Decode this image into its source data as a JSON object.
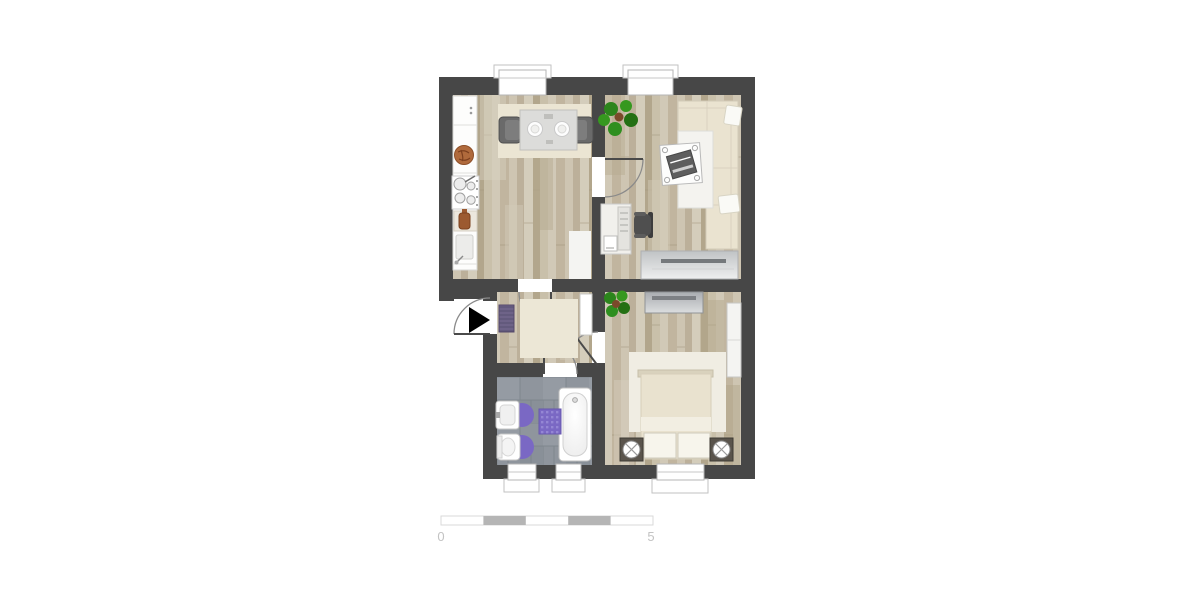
{
  "image": {
    "width": 1200,
    "height": 600,
    "background": "#ffffff"
  },
  "scale_bar": {
    "start_label": "0",
    "end_label": "5",
    "segments": 5,
    "segment_fill": "#b5b5b5",
    "outline": "#d9d9d9"
  },
  "palette": {
    "wall": "#474747",
    "wood_floor": "#c9c0ac",
    "bathroom_tile": "#8f959d",
    "accent_purple": "#7a68c4",
    "doormat_purple": "#6e6388",
    "plant_green": "#2f8f1f",
    "sofa_cream": "#eae3d0",
    "bed_cream": "#e9e2cf",
    "furniture_gray": "#c6c9cb",
    "window_white": "#ffffff"
  },
  "floorplan": {
    "rooms": [
      {
        "name": "kitchen",
        "furniture": [
          "kitchen-counter",
          "stove",
          "kitchen-sink",
          "dining-table",
          "dining-chairs",
          "dining-rug",
          "mat"
        ]
      },
      {
        "name": "living-room",
        "furniture": [
          "corner-sofa",
          "coffee-table",
          "decor-tray",
          "desk",
          "office-chair",
          "sideboard",
          "plant"
        ]
      },
      {
        "name": "hallway",
        "furniture": [
          "doormat",
          "rug",
          "shelf"
        ]
      },
      {
        "name": "bathroom",
        "furniture": [
          "bathtub",
          "washbasin",
          "toilet",
          "bath-mat"
        ]
      },
      {
        "name": "bedroom",
        "furniture": [
          "double-bed",
          "nightstand-left",
          "nightstand-right",
          "dresser",
          "wardrobe",
          "rug",
          "plant"
        ]
      }
    ],
    "doors": [
      "entrance-door",
      "kitchen-door",
      "living-room-door",
      "bathroom-door",
      "bedroom-door"
    ],
    "windows": [
      "kitchen-window",
      "living-room-window",
      "bathroom-window-1",
      "bathroom-window-2",
      "bedroom-window"
    ]
  }
}
